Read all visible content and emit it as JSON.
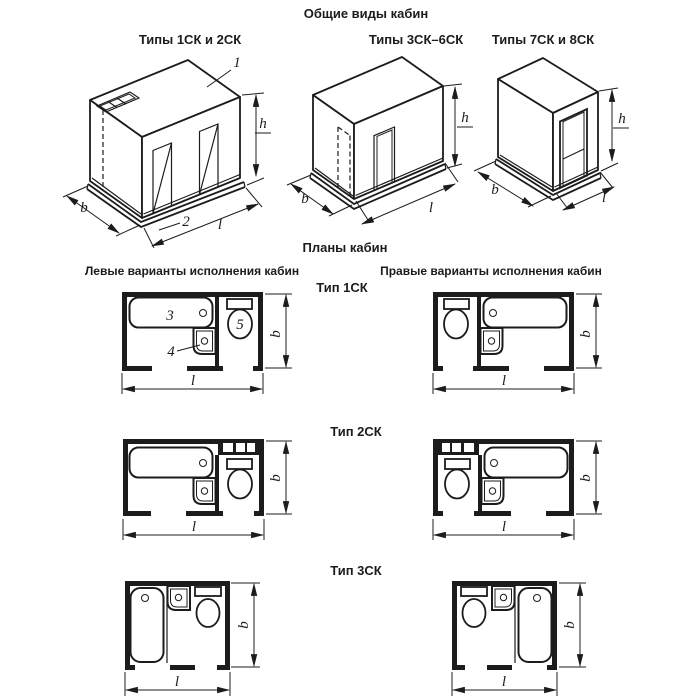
{
  "colors": {
    "background": "#ffffff",
    "ink": "#1c1c1c"
  },
  "titles": {
    "views": "Общие виды кабин",
    "plans": "Планы кабин"
  },
  "headers": {
    "left": "Левые варианты исполнения кабин",
    "right": "Правые варианты исполнения кабин"
  },
  "view_labels": {
    "v1": "Типы 1СК и 2СК",
    "v2": "Типы 3СК–6СК",
    "v3": "Типы 7СК и 8СК"
  },
  "row_labels": {
    "r1": "Тип 1СК",
    "r2": "Тип 2СК",
    "r3": "Тип 3СК"
  },
  "dims": {
    "width": "b",
    "length": "l",
    "height": "h"
  },
  "callouts": {
    "ceiling_panel": "1",
    "floor_panel": "2",
    "bath": "3",
    "washbasin": "4",
    "toilet": "5"
  }
}
